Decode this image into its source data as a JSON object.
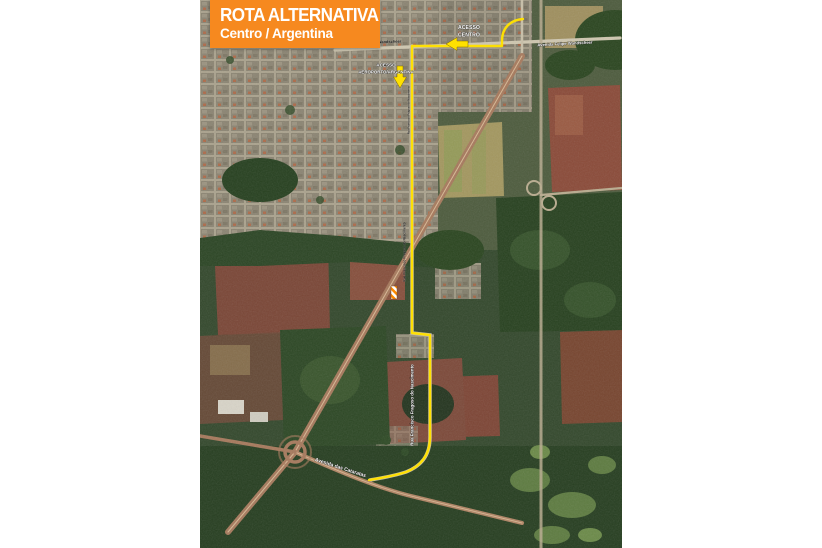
{
  "banner": {
    "title": "ROTA ALTERNATIVA",
    "subtitle": "Centro / Argentina"
  },
  "map_labels": {
    "acesso_centro_line1": "ACESSO",
    "acesso_centro_line2": "CENTRO",
    "acesso_aeroporto_line1": "ACESSO",
    "acesso_aeroporto_line2": "AEROPORTO/ARGENTINA",
    "avenida_felipe_west": "Avenida Felipe Wandscheer",
    "avenida_felipe_east": "Avenida Felipe Wandscheer",
    "rua_route_north": "Rua Francisco Fragoso do Nascimento",
    "rua_route_mid": "Rua Francisco Fragoso do Nascimento",
    "rua_route_south": "Rua Francisco Fragoso do Nascimento",
    "avenida_cataratas": "Avenida das Cataratas"
  },
  "icons": {
    "acesso_centro_arrow": "arrow-left",
    "aeroporto_arrow": "arrow-down",
    "closure_marker": "hazard-stripes"
  },
  "colors": {
    "banner_bg": "#F6891F",
    "banner_text": "#FFFFFF",
    "route_line": "#FFE100",
    "map_label_text": "#FFFFFF"
  }
}
